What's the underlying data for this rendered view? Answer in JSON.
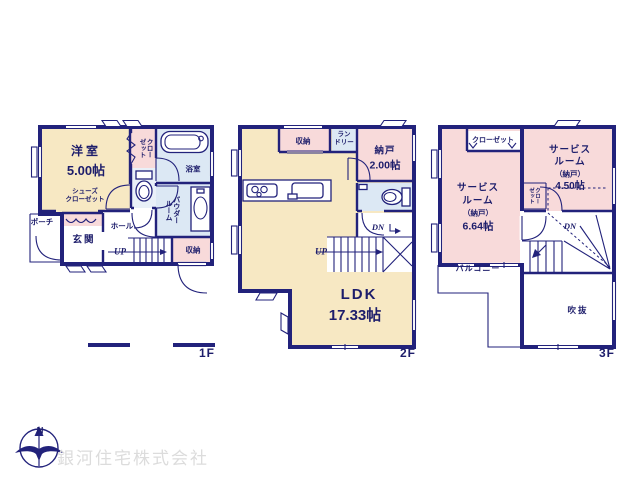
{
  "colors": {
    "wall": "#22227B",
    "cream": "#F7E8C3",
    "pink": "#F8DADA",
    "blue": "#DCE8F4",
    "text": "#1D1D6B",
    "watermark": "#DCDCDC"
  },
  "floor1": {
    "label": "1F",
    "western_room": {
      "name": "洋室",
      "size": "5.00帖"
    },
    "shoes_closet": {
      "line1": "シューズ",
      "line2": "クローゼット"
    },
    "closet": {
      "col1": "クロー",
      "col2": "ゼット"
    },
    "bath": "浴室",
    "powder_room": {
      "col1": "パウダー",
      "col2": "ルーム"
    },
    "porch": "ポーチ",
    "entrance": "玄関",
    "hall": "ホール",
    "storage": "収納",
    "stairs_up": "UP"
  },
  "floor2": {
    "label": "2F",
    "storage": "収納",
    "laundry": {
      "line1": "ラン",
      "line2": "ドリー"
    },
    "storeroom": {
      "name": "納戸",
      "size": "2.00帖"
    },
    "ldk": {
      "name": "LDK",
      "size": "17.33帖"
    },
    "stairs_up": "UP",
    "stairs_down": "DN"
  },
  "floor3": {
    "label": "3F",
    "closet_top": "クローゼット",
    "service_room_small": {
      "lines": [
        "サービス",
        "ルーム",
        "（納戸）",
        "4.50帖"
      ]
    },
    "service_room_large": {
      "lines": [
        "サービス",
        "ルーム",
        "（納戸）",
        "6.64帖"
      ]
    },
    "closet_side": {
      "col1": "クロー",
      "col2": "ゼット"
    },
    "stairs_down": "DN",
    "balcony": "バルコニー",
    "void": "吹抜"
  },
  "footer": {
    "company": "銀河住宅株式会社",
    "compass_north": "N"
  }
}
